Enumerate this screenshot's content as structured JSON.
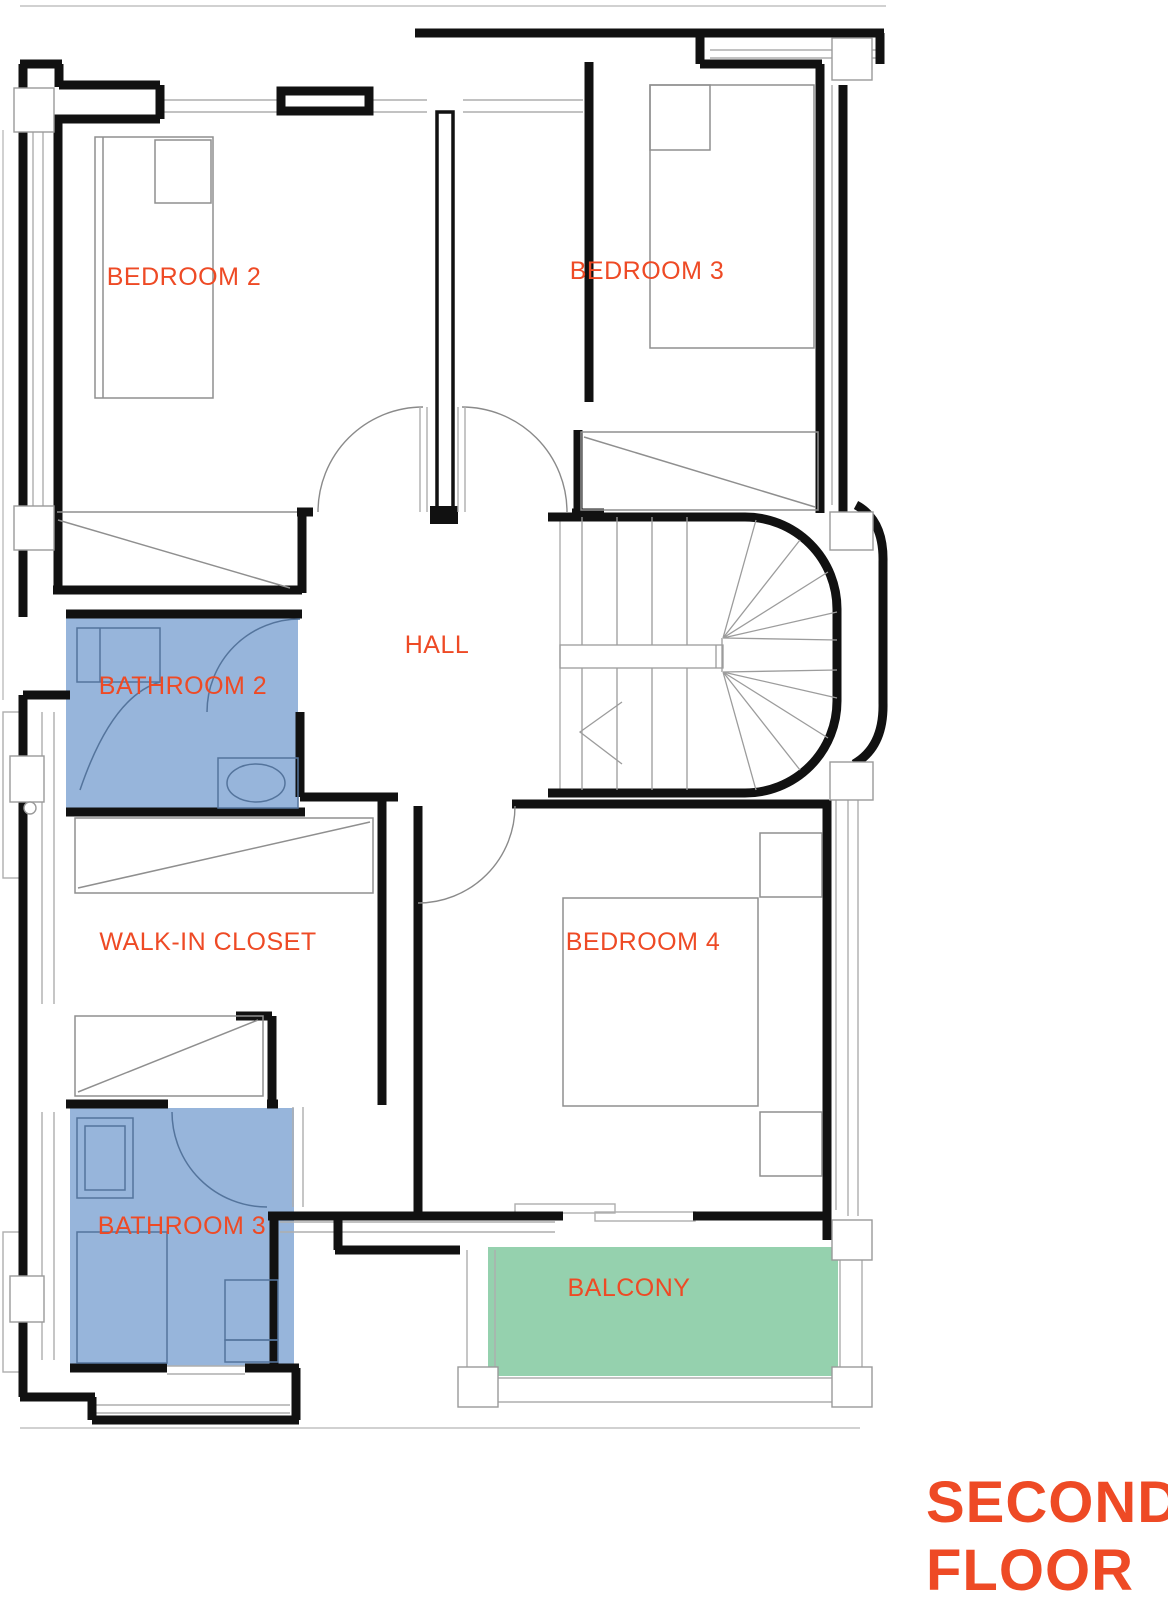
{
  "title": {
    "line1": "SECOND",
    "line2": "FLOOR"
  },
  "colors": {
    "accent": "#ee4a25",
    "wall": "#111111",
    "bathroom_fill": "#97b5db",
    "balcony_fill": "#95d1ae"
  },
  "rooms": {
    "bedroom2": {
      "label": "BEDROOM 2"
    },
    "bedroom3": {
      "label": "BEDROOM 3"
    },
    "hall": {
      "label": "HALL"
    },
    "bathroom2": {
      "label": "BATHROOM 2"
    },
    "walkin": {
      "label": "WALK-IN CLOSET"
    },
    "bedroom4": {
      "label": "BEDROOM 4"
    },
    "bathroom3": {
      "label": "BATHROOM 3"
    },
    "balcony": {
      "label": "BALCONY"
    }
  }
}
